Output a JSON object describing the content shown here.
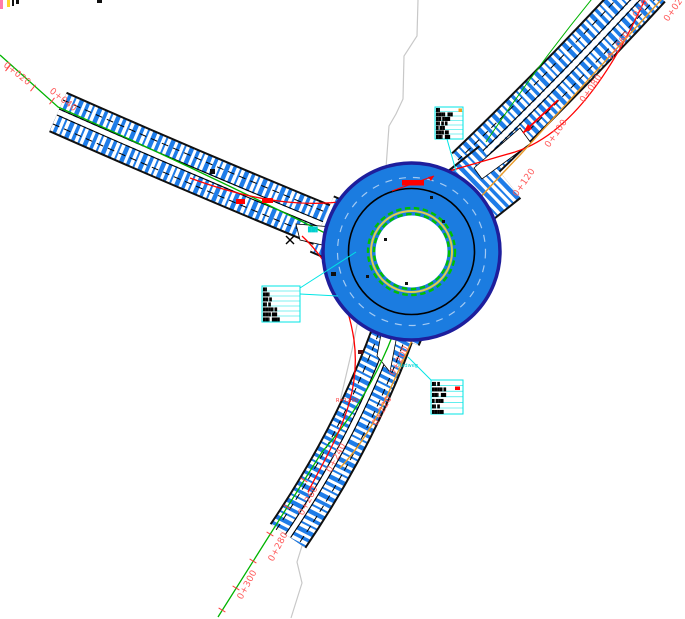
{
  "drawing_title": "Kreisverkehr Lageplan",
  "stations": {
    "nw": [
      {
        "label": "0+020"
      },
      {
        "label": "0+040"
      }
    ],
    "ne": [
      {
        "label": "0+120"
      },
      {
        "label": "0+100"
      },
      {
        "label": "0+080"
      },
      {
        "label": "0+060"
      },
      {
        "label": "0+040"
      },
      {
        "label": "0+020"
      }
    ],
    "s": [
      {
        "label": "0+200"
      },
      {
        "label": "0+220"
      },
      {
        "label": "0+240"
      },
      {
        "label": "0+260"
      },
      {
        "label": "0+280"
      },
      {
        "label": "0+300"
      }
    ]
  },
  "callouts": [
    {
      "rows": [
        "█▌",
        "███▌ ██",
        "██ ███",
        "█▌█ █",
        "█ ██",
        "███ █▌",
        "██▌ ██"
      ]
    },
    {
      "rows": [
        "█▌",
        "██▌",
        "██ █",
        "█▌█",
        "████ █",
        "███ ██",
        "██▌ ███"
      ]
    },
    {
      "rows": [
        "█▌█",
        "████ █",
        "██▌ ██",
        "█ ███",
        "█▌█",
        "████▌"
      ]
    }
  ],
  "notes": {
    "radius_note": "R=12.00",
    "cycleway_note": "Radweg",
    "small_cyan_note": "██▌"
  },
  "colors": {
    "hatch_blue": "#1E7CE8",
    "circle_fill": "#1B7CE0",
    "navy_outline": "#1E1E9C",
    "alignment_green": "#00B400",
    "alignment_red": "#FF0000",
    "station_red": "#FF5A5A",
    "alignment_orange": "#E89A28",
    "callout_cyan": "#00E5E5",
    "boundary_gray": "#C8C8C8",
    "apron_yellow": "#E0CC50"
  }
}
